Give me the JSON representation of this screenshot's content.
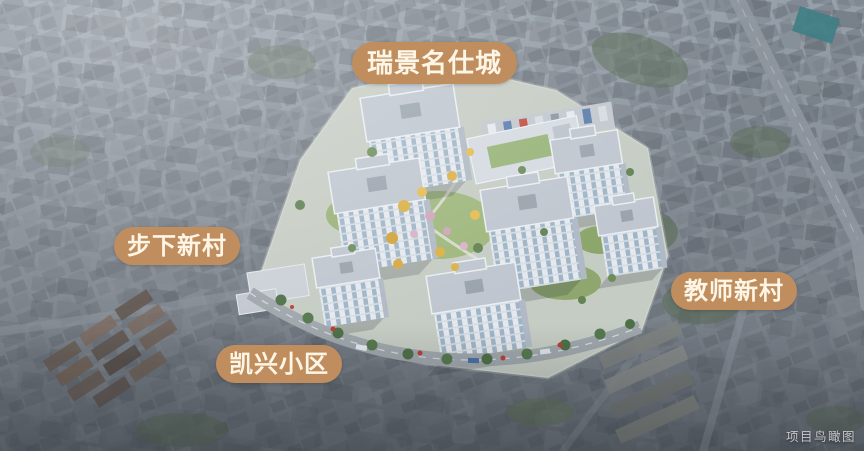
{
  "labels": {
    "project": "瑞景名仕城",
    "west_neighborhood": "步下新村",
    "east_neighborhood": "教师新村",
    "south_neighborhood": "凯兴小区"
  },
  "watermark": "项目鸟瞰图",
  "colors": {
    "label_background": "#c08e5e",
    "label_text": "#fdf6e6",
    "watermark_text": "#d9dadb"
  }
}
